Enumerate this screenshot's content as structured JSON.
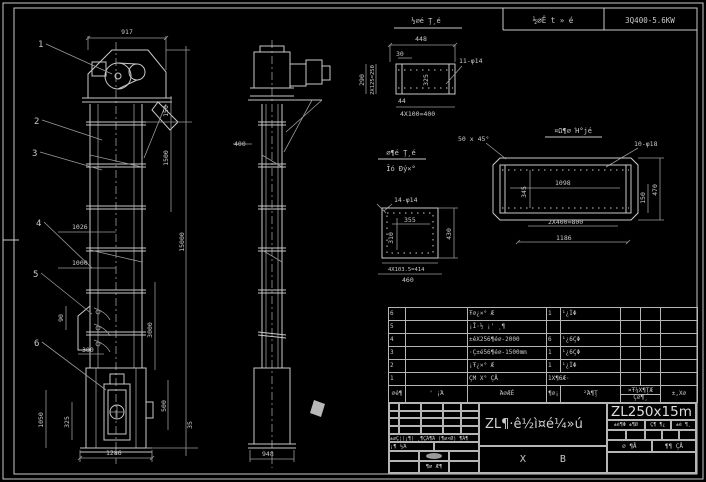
{
  "header": {
    "mid": "½∅Ê t » é",
    "right": "3Q400-5.6KW"
  },
  "front": {
    "balloons": [
      "1",
      "2",
      "3",
      "4",
      "5",
      "6"
    ],
    "dims": {
      "w917": "917",
      "d150": "150",
      "d1500": "1500",
      "d15000": "15000",
      "d3000": "3000",
      "d500": "500",
      "d35": "35",
      "d1026": "1026",
      "d1000": "1000",
      "d90": "90",
      "d300": "300",
      "d1050": "1050",
      "d325": "325",
      "d1286": "1286"
    }
  },
  "side": {
    "dims": {
      "d948": "948",
      "d400": "400"
    }
  },
  "detail_a": {
    "title": "½∅é Ţ¸é",
    "dims": {
      "top": "448",
      "offset": "30",
      "left": "290",
      "pitch": "2X125=250",
      "holes": "11-φ14",
      "inner": "325",
      "small": "44",
      "bottom": "4X100=400"
    }
  },
  "detail_b": {
    "title1": "∅¶é Ţ¸é",
    "title2": "Ĭó Ðý×°",
    "dims": {
      "holes": "14-φ14",
      "inner_w": "355",
      "inner_h": "310",
      "right": "430",
      "bottom1": "4X103.5=414",
      "bottom2": "460"
    }
  },
  "detail_c": {
    "title": "¤Ω¶∅ Ή°jé",
    "chamfer": "50 x 45°",
    "dims": {
      "holes": "10-φ18",
      "inner": "1098",
      "inner_v": "345",
      "r150": "150",
      "r470": "470",
      "bottom1": "2X400=800",
      "bottom2": "1186"
    }
  },
  "table": {
    "header": {
      "no": "∅é¶",
      "dwg": "' ¡Ά",
      "name": "Ά∅ÆÈ",
      "qty": "¶∅¡",
      "mat": "²Ά¶Ţ",
      "unit": "¤Ŧ¼X¶ŢÆ",
      "total": "Ç∅¶¸",
      "rem": "±,X∅"
    },
    "rows": [
      {
        "no": "6",
        "dwg": "",
        "name": "Ŧ∅¿×° Æ",
        "qty": "1",
        "mat": "¹¿ÌΦ",
        "w1": "",
        "w2": "",
        "rem": ""
      },
      {
        "no": "5",
        "dwg": "",
        "name": "¡Ī·½ ¡' ¸¶",
        "qty": "",
        "mat": "",
        "w1": "",
        "w2": "",
        "rem": ""
      },
      {
        "no": "4",
        "dwg": "",
        "name": "±éX256¶é∅-2000",
        "qty": "6",
        "mat": "¹¿6ÇΦ",
        "w1": "",
        "w2": "",
        "rem": ""
      },
      {
        "no": "3",
        "dwg": "",
        "name": "·Ç±é56¶é∅-1500mm",
        "qty": "1",
        "mat": "¹¿6ÇΦ",
        "w1": "",
        "w2": "",
        "rem": ""
      },
      {
        "no": "2",
        "dwg": "",
        "name": "¡Ŧ¿×° Æ",
        "qty": "1",
        "mat": "¹¿ÌΦ",
        "w1": "",
        "w2": "",
        "rem": ""
      },
      {
        "no": "1",
        "dwg": "",
        "name": "ÇΜ X° ÇÅ",
        "qty": "1X¶6Æ·",
        "mat": "",
        "w1": "",
        "w2": "",
        "rem": ""
      }
    ]
  },
  "titleblock": {
    "model": "ZL250x15m",
    "main_title": "ZL¶·ê½ì¤é¼»ú",
    "sub_title": "Χ Β",
    "sign_row": "±∅Ç¦(¡¶) ¸¶ÇΆ¶Ά (¶∅×Ø) ¶Ά¶",
    "check_row": "¡¶ ½Ά",
    "bottom_row": "¶∅ Æ¶",
    "wt_label": "±é¶Φ ±¶Ø",
    "scale_label": "Ç¶ ¶¿",
    "ratio_label": "±é ¶¸",
    "sheet_no": "∅ ¶Å",
    "sheet_total": "¶¶ ÇÅ"
  }
}
